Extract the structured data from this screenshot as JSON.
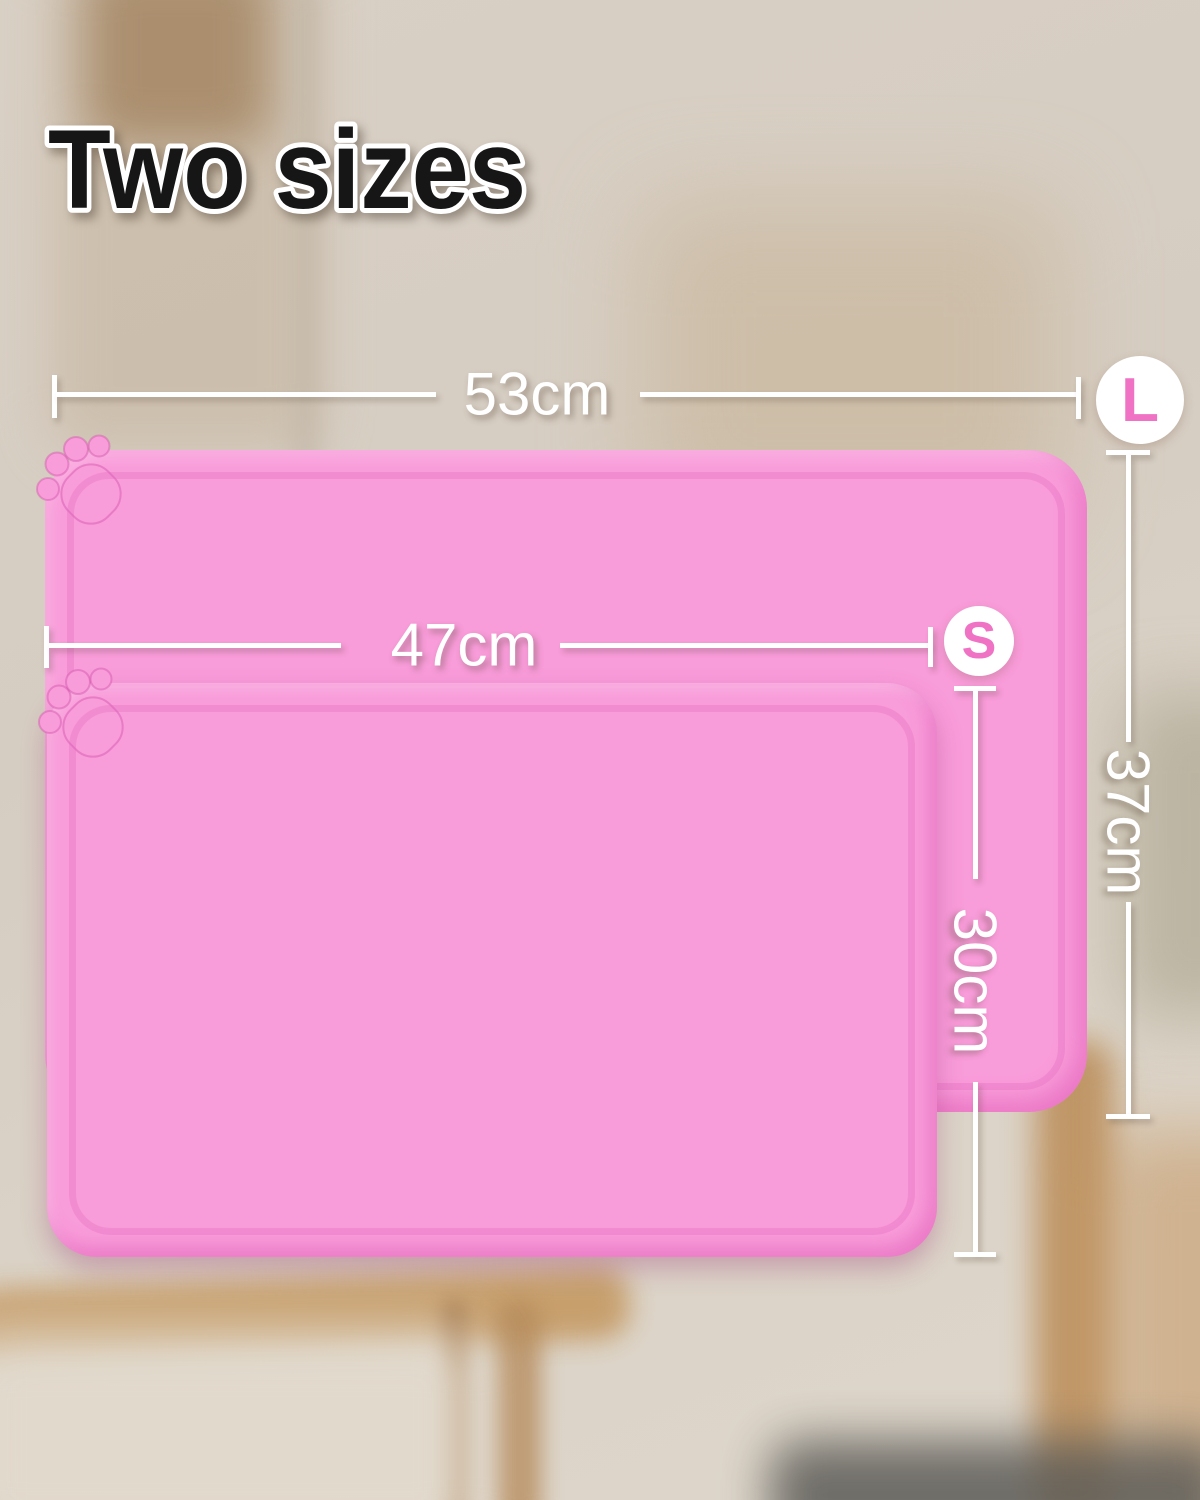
{
  "title": "Two sizes",
  "mats": {
    "large": {
      "name": "Large pet feeding mat",
      "badge": "L",
      "width": "53cm",
      "height": "37cm"
    },
    "small": {
      "name": "Small pet feeding mat",
      "badge": "S",
      "width": "47cm",
      "height": "30cm"
    }
  },
  "icons": {
    "corner_decoration": "paw-print-icon"
  },
  "colors": {
    "mat_pink": "#f99cda",
    "mat_rim_pink": "#e068be",
    "badge_letter_pink": "#ef72c5",
    "annotation_white": "#ffffff",
    "title_black": "#161616",
    "title_outline": "#ffffff",
    "background_beige": "#d7cec3",
    "wood_brown": "#c49a6b"
  }
}
